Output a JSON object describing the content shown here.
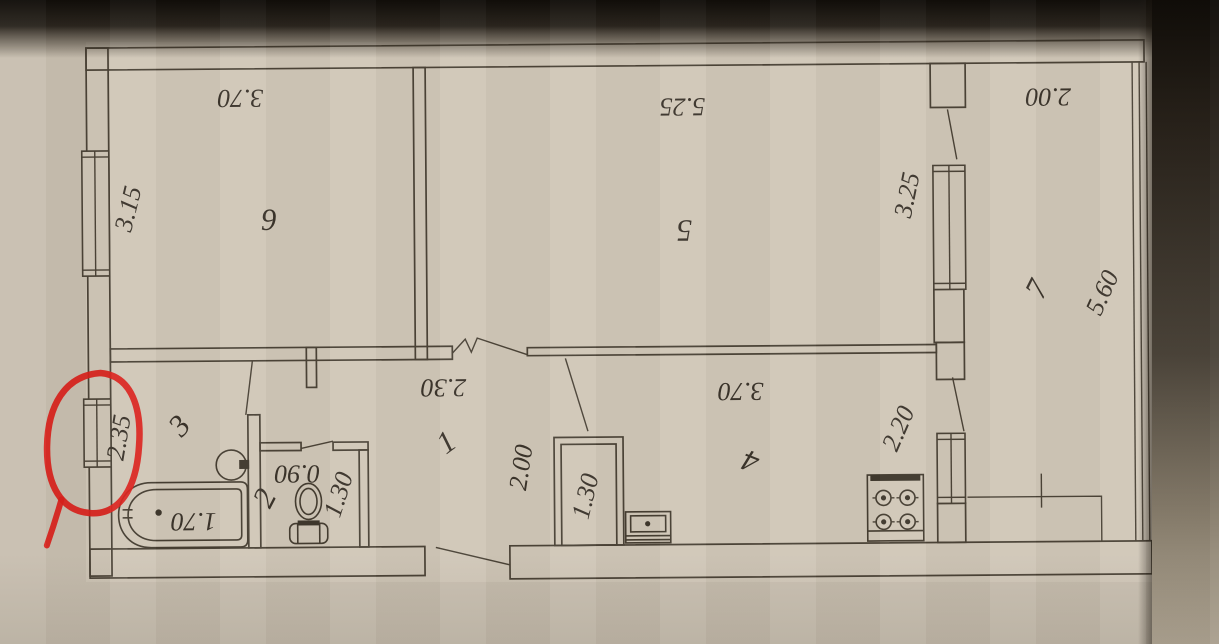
{
  "labels": {
    "room6": {
      "number": "6",
      "top": "3.70",
      "side": "3.15"
    },
    "room5": {
      "number": "5",
      "top": "5.25",
      "side": "3.25"
    },
    "room7": {
      "number": "7",
      "top": "2.00",
      "side": "5.60"
    },
    "room1": {
      "number": "1",
      "top": "2.30",
      "side": "2.00"
    },
    "room4": {
      "number": "4",
      "top": "3.70",
      "side": "2.20"
    },
    "room3": {
      "number": "3",
      "side": "2.35",
      "bathtub": "1.70"
    },
    "room2": {
      "number": "2",
      "top": "0.90",
      "side": "1.30"
    },
    "closet": {
      "side": "1.30"
    }
  },
  "fixtures": [
    "bathtub",
    "washbasin",
    "toilet",
    "kitchen-sink",
    "gas-stove-4-burner"
  ],
  "windows": [
    "room6-left-wall",
    "bathroom-left-wall",
    "room5-balcony-wall",
    "kitchen-balcony-wall"
  ],
  "annotation": {
    "shape": "hand-drawn-circle",
    "target": "bathroom-left-wall-window"
  },
  "colors": {
    "paper": "#c8bfb0",
    "plan_paper": "#d0c7b8",
    "ink": "#4a4236",
    "label_ink": "#3a332a",
    "annotation_red": "#da201a"
  }
}
